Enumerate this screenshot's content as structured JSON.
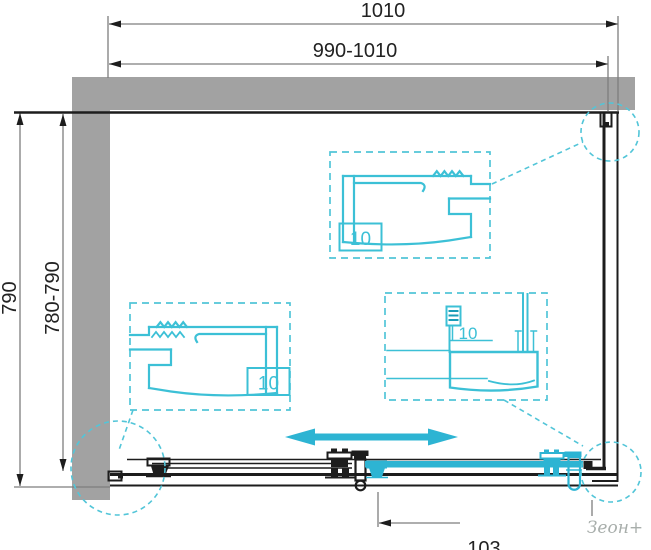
{
  "drawing": {
    "type": "shower-enclosure-installation-diagram",
    "dimensions": {
      "width_total": "1010",
      "width_range": "990-1010",
      "height_total": "790",
      "height_range": "780-790",
      "bottom_offset": "103"
    },
    "details": {
      "top_profile_label": "10",
      "left_profile_label": "10",
      "rail_section_label": "10"
    },
    "watermark": "Зеон+",
    "colors": {
      "accent_cyan": "#2db4d3",
      "detail_cyan": "#3cc0d6",
      "dash_cyan": "#52c5d8",
      "wall_gray": "#a2a2a2",
      "line_black": "#1d1d1d",
      "dim_gray": "#7e7e7e",
      "watermark_gray": "#a8aeab"
    }
  }
}
